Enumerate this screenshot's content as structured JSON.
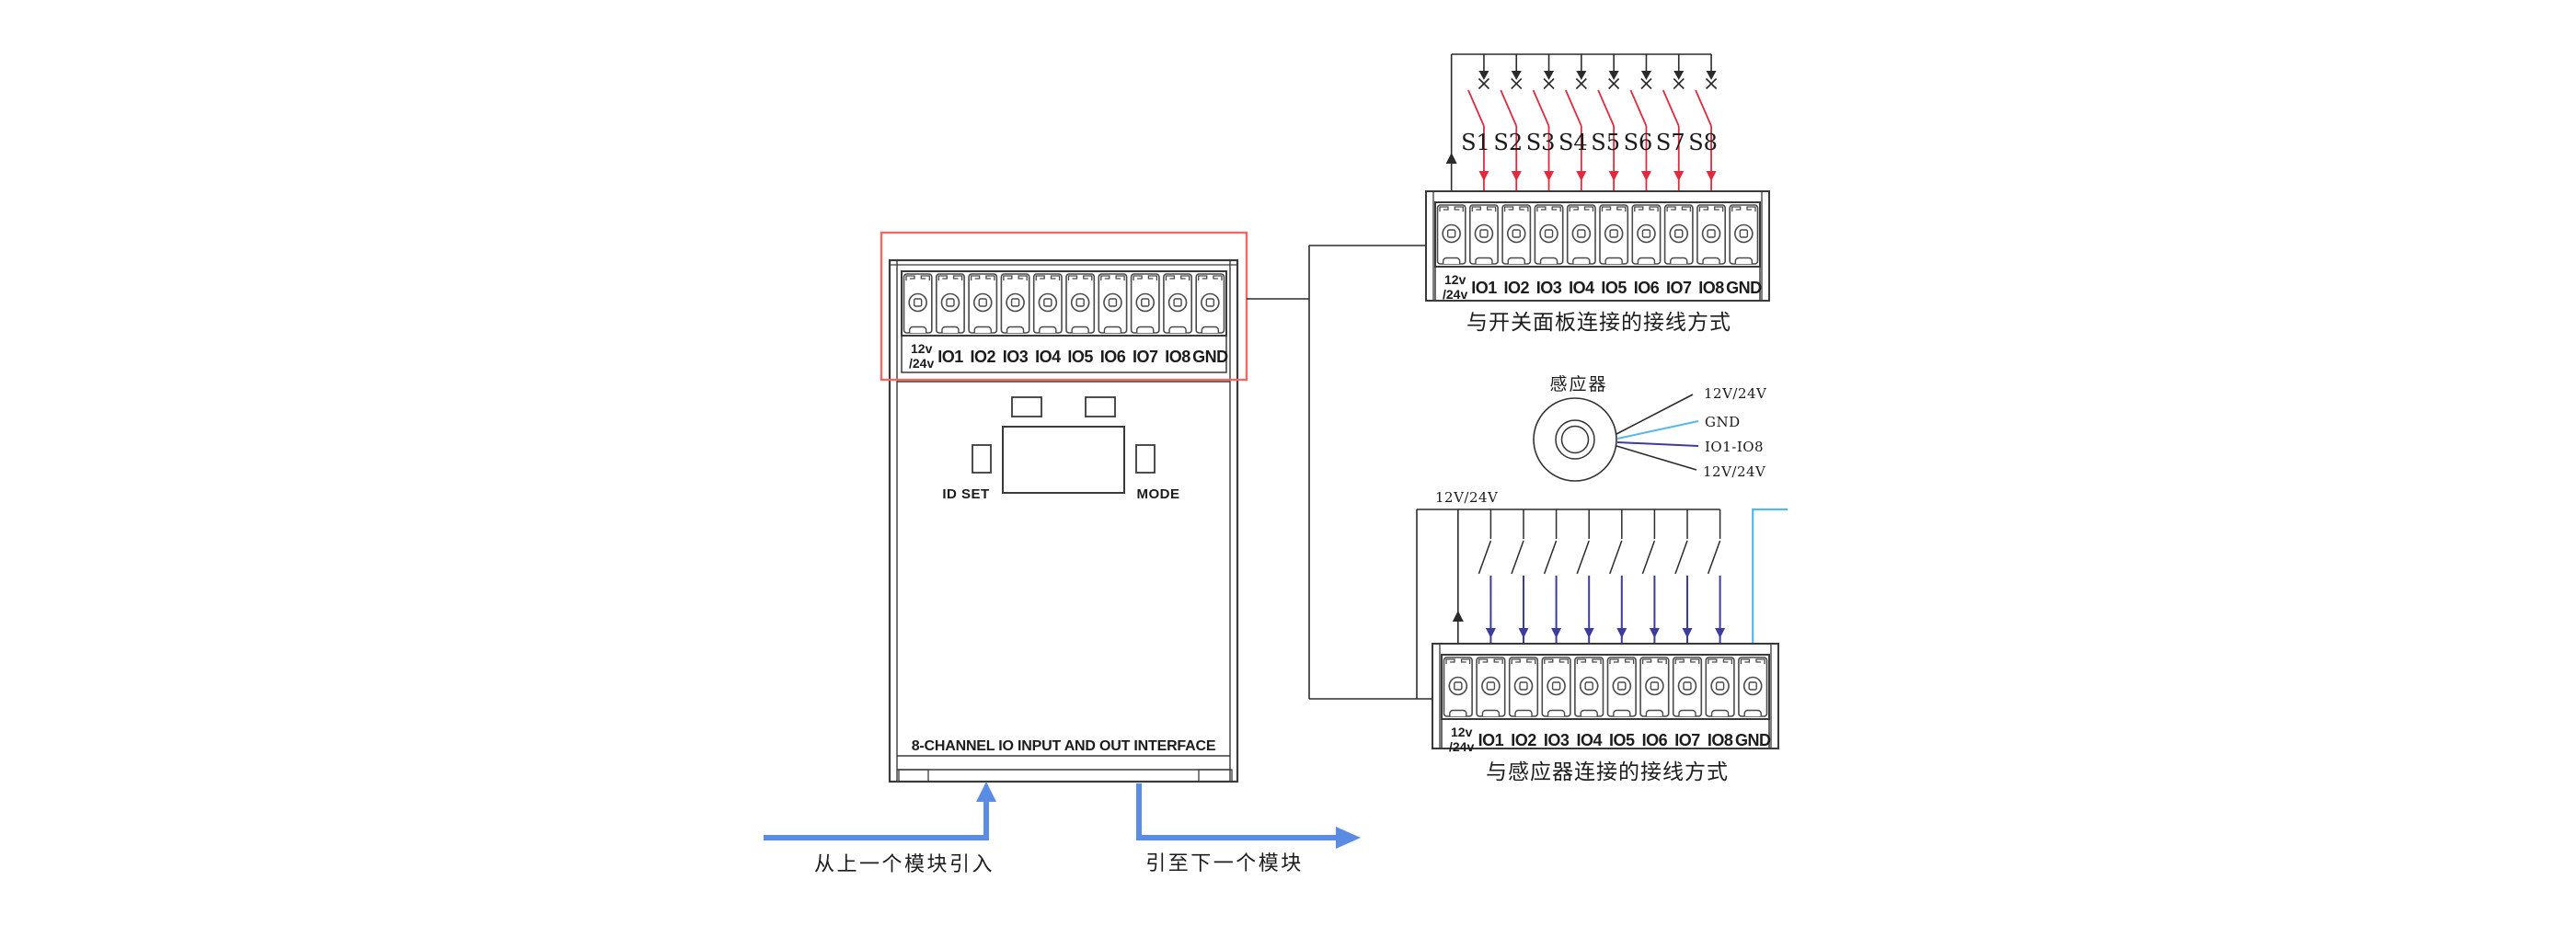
{
  "terminal_block": {
    "power_label_line1": "12v",
    "power_label_line2": "/24v",
    "io_labels": [
      "IO1",
      "IO2",
      "IO3",
      "IO4",
      "IO5",
      "IO6",
      "IO7",
      "IO8"
    ],
    "ground_label": "GND"
  },
  "device": {
    "footer_label": "8-CHANNEL IO INPUT AND OUT INTERFACE",
    "id_set_label": "ID SET",
    "mode_label": "MODE"
  },
  "switch_panel_diagram": {
    "caption": "与开关面板连接的接线方式",
    "switch_labels": [
      "S1",
      "S2",
      "S3",
      "S4",
      "S5",
      "S6",
      "S7",
      "S8"
    ]
  },
  "sensor_wiring_diagram": {
    "caption": "与感应器连接的接线方式",
    "bus_label": "12V/24V"
  },
  "sensor": {
    "label": "感应器",
    "leads": [
      {
        "label": "12V/24V"
      },
      {
        "label": "GND"
      },
      {
        "label": "IO1-IO8"
      },
      {
        "label": "12V/24V"
      }
    ]
  },
  "flow_arrows": {
    "in_label": "从上一个模块引入",
    "out_label": "引至下一个模块"
  },
  "colors": {
    "line": "#2b2b2b",
    "device_stroke": "#3a3a3a",
    "cell_stroke": "#4a4a4a",
    "highlight_box": "#ee6a6a",
    "switch_wire": "#e02a3e",
    "sensor_wire": "#3c3c9e",
    "gnd_wire": "#58b8e8",
    "flow_arrow": "#5b8ce4",
    "switch_label_color": "#3a4a6b",
    "label_text": "#1d1d1d"
  }
}
